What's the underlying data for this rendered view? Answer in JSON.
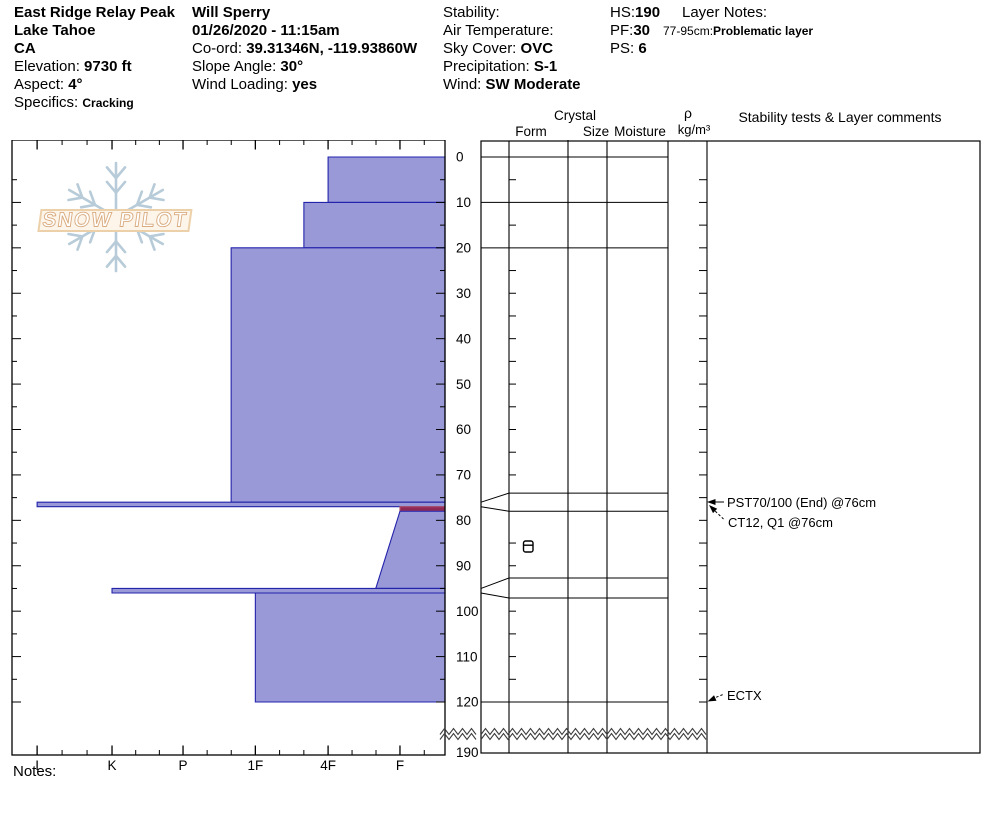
{
  "header": {
    "columns": [
      {
        "name": "location",
        "lines": [
          {
            "value": "East Ridge Relay Peak"
          },
          {
            "value": "Lake Tahoe"
          },
          {
            "value": "CA"
          },
          {
            "label": "Elevation: ",
            "value": "9730 ft"
          },
          {
            "label": "Aspect: ",
            "value": "4°"
          },
          {
            "label": "Specifics: ",
            "value": "Cracking",
            "small": true
          }
        ]
      },
      {
        "name": "observer",
        "lines": [
          {
            "value": "Will Sperry"
          },
          {
            "value": "01/26/2020 - 11:15am"
          },
          {
            "label": "Co-ord: ",
            "value": "39.31346N, -119.93860W"
          },
          {
            "label": "Slope Angle: ",
            "value": "30°"
          },
          {
            "label": "Wind Loading: ",
            "value": "yes"
          }
        ]
      },
      {
        "name": "conditions",
        "lines": [
          {
            "label": "Stability:",
            "value": ""
          },
          {
            "label": "Air Temperature:",
            "value": ""
          },
          {
            "label": "Sky Cover: ",
            "value": "OVC"
          },
          {
            "label": "Precipitation: ",
            "value": "S-1"
          },
          {
            "label": "Wind:  ",
            "value": "SW Moderate"
          }
        ]
      },
      {
        "name": "measurements",
        "lines": [
          {
            "label": "HS:",
            "value": "190"
          },
          {
            "label": "PF:",
            "value": "30"
          },
          {
            "label": "PS: ",
            "value": "6"
          }
        ]
      }
    ],
    "layer_notes": {
      "title": "Layer Notes:",
      "notes": [
        {
          "range": "77-95cm:",
          "text": "Problematic layer"
        }
      ]
    }
  },
  "logo": {
    "text": "SNOW PILOT"
  },
  "chart_data": {
    "type": "bar",
    "title": "Snow pit hand-hardness profile",
    "orientation": "horizontal bars vs depth",
    "x_axis": {
      "label": "hand hardness (soft F to ice I)",
      "ticks": [
        "I",
        "K",
        "P",
        "1F",
        "4F",
        "F"
      ]
    },
    "y_axis": {
      "label": "depth (cm)",
      "tick_interval": 10,
      "ticks": [
        0,
        10,
        20,
        30,
        40,
        50,
        60,
        70,
        80,
        90,
        100,
        110,
        120
      ],
      "break_label": 190
    },
    "hs_cm": 190,
    "pit_depth_cm": 120,
    "layers": [
      {
        "top_cm": 0,
        "bottom_cm": 10,
        "hardness": "4F"
      },
      {
        "top_cm": 10,
        "bottom_cm": 20,
        "hardness": "4F+"
      },
      {
        "top_cm": 20,
        "bottom_cm": 76,
        "hardness": "1F+"
      },
      {
        "top_cm": 76,
        "bottom_cm": 77,
        "hardness": "I"
      },
      {
        "top_cm": 77,
        "bottom_cm": 78,
        "hardness": "F",
        "problematic": true
      },
      {
        "top_cm": 78,
        "bottom_cm": 95,
        "hardness": "F",
        "hardness_bottom": "F+"
      },
      {
        "top_cm": 95,
        "bottom_cm": 96,
        "hardness": "K"
      },
      {
        "top_cm": 96,
        "bottom_cm": 120,
        "hardness": "1F"
      }
    ]
  },
  "right_panel": {
    "crystal_header": "Crystal",
    "form_header": "Form",
    "size_header": "Size",
    "moisture_header": "Moisture",
    "density_symbol": "ρ",
    "density_units": "kg/m³",
    "comments_header": "Stability tests & Layer comments",
    "display_boundaries_cm": [
      0,
      10,
      20,
      74,
      78,
      92.7,
      97.1,
      120
    ],
    "expanded_thin_layers": [
      {
        "true_top": 76,
        "true_bottom": 77,
        "disp_top": 74,
        "disp_bottom": 78
      },
      {
        "true_top": 95,
        "true_bottom": 96,
        "disp_top": 92.7,
        "disp_bottom": 97.1
      }
    ],
    "grain_symbols": [
      {
        "depth_cm": 86,
        "column": "Form",
        "symbol": "crust"
      }
    ],
    "annotations": [
      {
        "text": "PST70/100 (End) @76cm",
        "target_cm": 76
      },
      {
        "text": "CT12, Q1 @76cm",
        "target_cm": 76.5
      },
      {
        "text": "ECTX",
        "target_cm": 120
      }
    ]
  },
  "notes_label": "Notes:",
  "colors": {
    "bar_fill": "#9a99d8",
    "bar_stroke": "#2323ab",
    "problem_fill": "#8e2956",
    "problem_stroke": "#b0506a",
    "logo_fill": "#ffffff",
    "logo_outline": "#d9ab7e",
    "logo_band": "#ecd0a9",
    "snowflake": "#b7cbd8"
  }
}
